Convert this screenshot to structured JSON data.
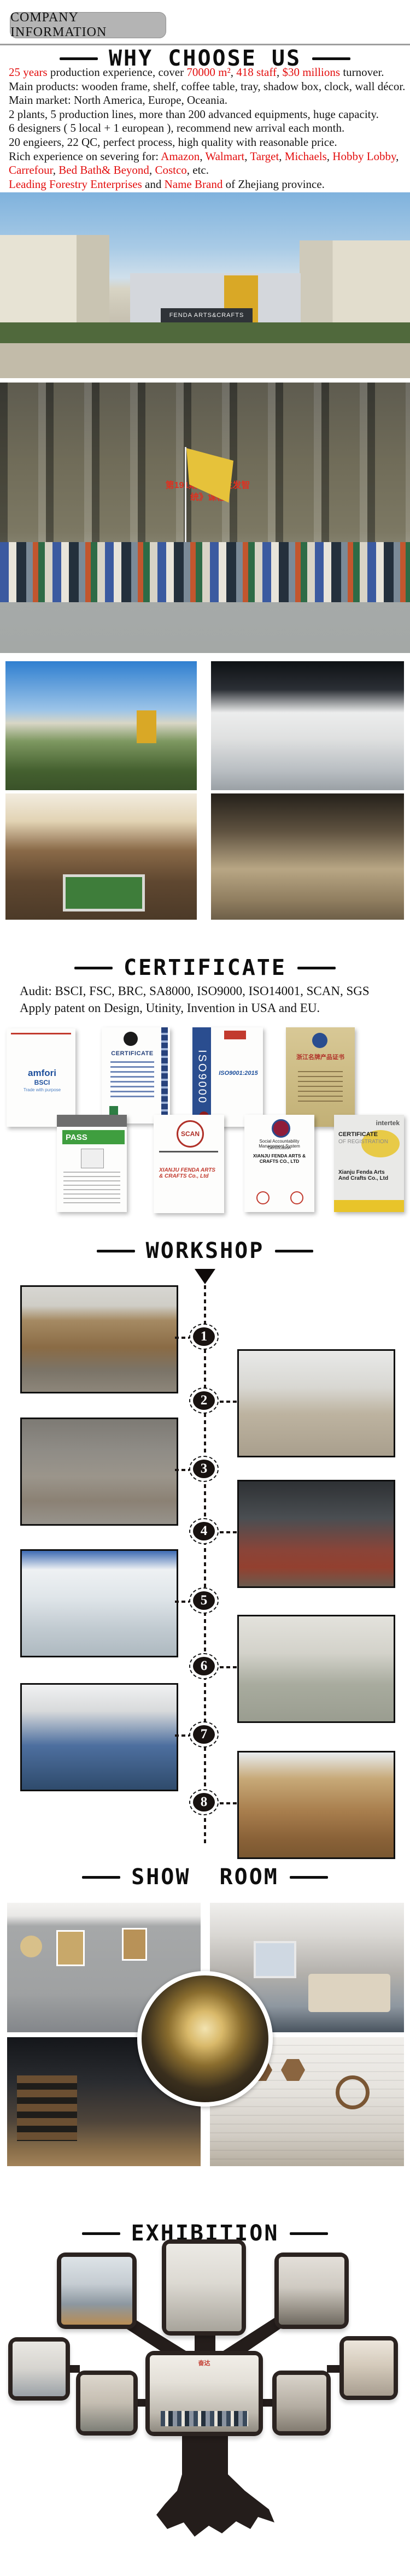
{
  "colors": {
    "accent_red": "#e30e0e",
    "badge_gray": "#b4b4b4",
    "tree_dark": "#241d1b",
    "heading_black": "#0e0e0e"
  },
  "header": {
    "badge": "COMPANY INFORMATION"
  },
  "why": {
    "title": "WHY CHOOSE US",
    "lines": [
      [
        {
          "t": "25 years",
          "red": true
        },
        {
          "t": " production experience, cover "
        },
        {
          "t": "70000 m²",
          "red": true
        },
        {
          "t": ", "
        },
        {
          "t": "418 staff",
          "red": true
        },
        {
          "t": ", "
        },
        {
          "t": "$30 millions",
          "red": true
        },
        {
          "t": " turnover."
        }
      ],
      [
        {
          "t": "Main products: wooden frame, shelf, coffee table, tray, shadow box, clock, wall décor."
        }
      ],
      [
        {
          "t": "Main market: North America, Europe, Oceania."
        }
      ],
      [
        {
          "t": "2 plants, 5 production lines, more than 200 advanced equipments, huge capacity."
        }
      ],
      [
        {
          "t": "6 designers ( 5 local + 1 european ), recommend new arrival each month."
        }
      ],
      [
        {
          "t": "20 engieers, 22 QC, perfect process, high quality with reasonable price."
        }
      ],
      [
        {
          "t": "Rich experience on severing for: "
        },
        {
          "t": "Amazon",
          "red": true
        },
        {
          "t": ", "
        },
        {
          "t": "Walmart",
          "red": true
        },
        {
          "t": ", "
        },
        {
          "t": "Target",
          "red": true
        },
        {
          "t": ", "
        },
        {
          "t": "Michaels",
          "red": true
        },
        {
          "t": ", "
        },
        {
          "t": "Hobby Lobby",
          "red": true
        },
        {
          "t": ", "
        },
        {
          "t": "Carrefour",
          "red": true
        },
        {
          "t": ", "
        },
        {
          "t": "Bed Bath& Beyond",
          "red": true
        },
        {
          "t": ", "
        },
        {
          "t": "Costco",
          "red": true
        },
        {
          "t": ", etc."
        }
      ],
      [
        {
          "t": "Leading Forestry Enterprises",
          "red": true
        },
        {
          "t": " and "
        },
        {
          "t": "Name Brand",
          "red": true
        },
        {
          "t": " of  Zhejiang province."
        }
      ]
    ]
  },
  "factory": {
    "sign": "FENDA ARTS&CRAFTS"
  },
  "group_photo": {
    "led_line1": "第191期《全员生发智",
    "led_line2": "统》课程"
  },
  "certificate": {
    "title": "CERTIFICATE",
    "audit_line": "Audit: BSCI, FSC, BRC, SA8000, ISO9000, ISO14001, SCAN,  SGS",
    "patent_line": "Apply patent on Design, Utinity, Invention in USA and EU.",
    "certs": {
      "bsci": {
        "brand": "amfori",
        "suffix": "BSCI",
        "tagline": "Trade with purpose"
      },
      "fsc": {
        "title": "CERTIFICATE"
      },
      "iso": {
        "side": "ISO9000",
        "standard": "ISO9001:2015"
      },
      "name_brand": {
        "title": "浙江名牌产品证书"
      },
      "pass": {
        "title": "PASS"
      },
      "scan": {
        "title": "SCAN",
        "org": "XIANJU FENDA ARTS & CRAFTS Co., Ltd"
      },
      "sa8000": {
        "line1": "Social Accountability Management System",
        "line2": "Certification",
        "org": "XIANJU FENDA ARTS & CRAFTS CO., LTD"
      },
      "intertek": {
        "brand": "intertek",
        "title": "CERTIFICATE",
        "subtitle": "OF REGISTRATION",
        "org": "Xianju Fenda Arts And Crafts Co., Ltd"
      }
    }
  },
  "workshop": {
    "title": "WORKSHOP",
    "steps": [
      {
        "n": "1"
      },
      {
        "n": "2"
      },
      {
        "n": "3"
      },
      {
        "n": "4"
      },
      {
        "n": "5"
      },
      {
        "n": "6"
      },
      {
        "n": "7"
      },
      {
        "n": "8"
      }
    ]
  },
  "showroom": {
    "title": "SHOW ROOM"
  },
  "exhibition": {
    "title": "EXHIBITION",
    "booth_sign": "奋达"
  }
}
